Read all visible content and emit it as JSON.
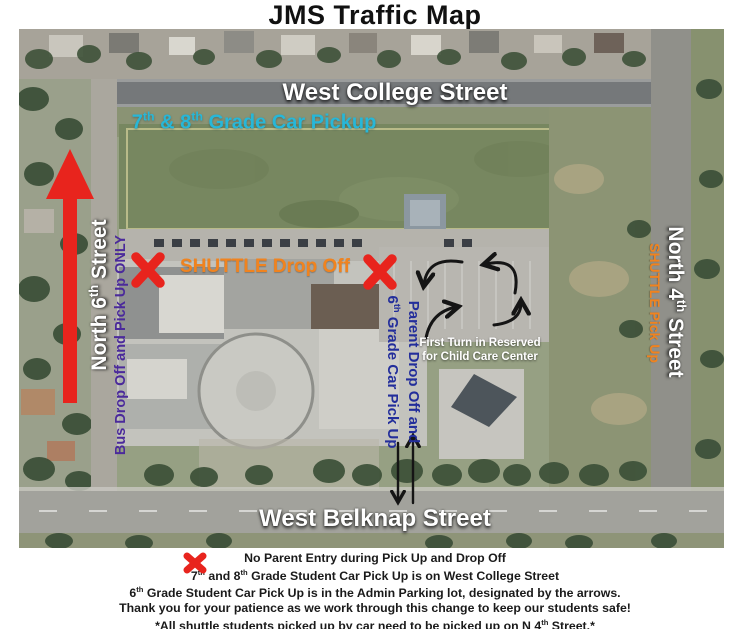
{
  "title": "JMS Traffic Map",
  "map": {
    "streets": {
      "college": "West College Street",
      "belknap": "West Belknap Street",
      "north6": "North 6th Street",
      "north4": "North 4th Street"
    },
    "annotations": {
      "grade78_pickup": "7th & 8th Grade Car Pickup",
      "bus_only": "Bus Drop Off and Pick Up ONLY",
      "shuttle_drop": "SHUTTLE Drop Off",
      "shuttle_pick": "SHUTTLE Pick Up",
      "parent_line1": "Parent Drop Off and",
      "parent_line2": "6th Grade Car Pick Up",
      "child_care_line1": "First Turn in Reserved",
      "child_care_line2": "for Child Care Center"
    }
  },
  "legend": {
    "lines": [
      "No Parent Entry during Pick Up and Drop Off",
      "7th and 8th Grade Student Car Pick Up is on West College Street",
      "6th Grade Student Car Pick Up is in the Admin Parking lot, designated by the arrows.",
      "Thank you for your patience as we work through this change to keep our students safe!",
      "*All shuttle students picked up by car need to be picked up on N 4th Street.*"
    ]
  },
  "colors": {
    "accent_red": "#e8241d",
    "cyan": "#27b7d8",
    "orange": "#f0831f",
    "purple": "#4b2a9b",
    "navy": "#232e9b",
    "arrow_black": "#151515",
    "street_white": "#ffffff"
  }
}
